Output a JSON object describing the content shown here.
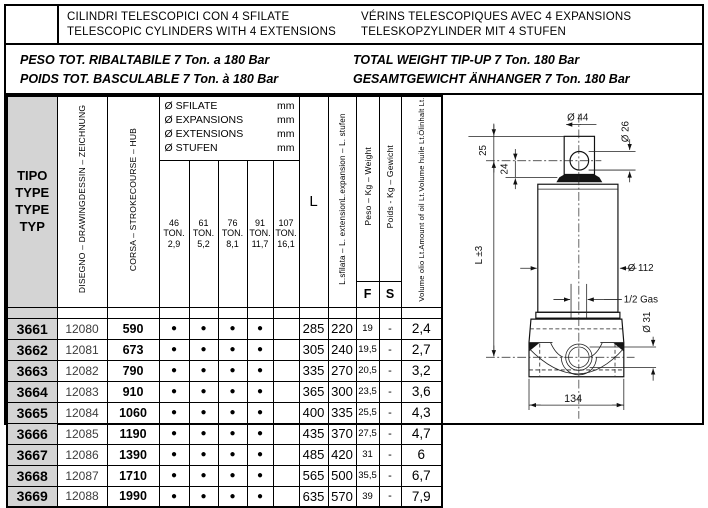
{
  "page": {
    "title_block": {
      "line_it": "CILINDRI TELESCOPICI CON 4 SFILATE",
      "line_en": "TELESCOPIC CYLINDERS WITH 4 EXTENSIONS",
      "line_fr": "VÉRINS TELESCOPIQUES AVEC 4 EXPANSIONS",
      "line_de": "TELESKOPZYLINDER MIT 4 STUFEN"
    },
    "weight_block": {
      "line_it": "PESO TOT. RIBALTABILE 7 Ton. a 180 Bar",
      "line_fr": "POIDS TOT. BASCULABLE 7 Ton. à 180 Bar",
      "line_en": "TOTAL WEIGHT TIP-UP  7 Ton. 180 Bar",
      "line_de": "GESAMTGEWICHT ÄNHANGER 7 Ton. 180 Bar"
    }
  },
  "table": {
    "bullet": "●",
    "headers": {
      "tipo_lines": [
        "TIPO",
        "TYPE",
        "TYPE",
        "TYP"
      ],
      "disegno_lines": [
        "DISEGNO – DRAWING",
        "DESSIN – ZEICHNUNG"
      ],
      "corsa_lines": [
        "CORSA  – STROKE",
        "COURSE – HUB"
      ],
      "diam_lines": [
        [
          "Ø SFILATE",
          "mm"
        ],
        [
          "Ø EXPANSIONS",
          "mm"
        ],
        [
          "Ø EXTENSIONS",
          "mm"
        ],
        [
          "Ø STUFEN",
          "mm"
        ]
      ],
      "ton_cols": [
        {
          "size": "46",
          "unit": "TON.",
          "cap": "2,9"
        },
        {
          "size": "61",
          "unit": "TON.",
          "cap": "5,2"
        },
        {
          "size": "76",
          "unit": "TON.",
          "cap": "8,1"
        },
        {
          "size": "91",
          "unit": "TON.",
          "cap": "11,7"
        },
        {
          "size": "107",
          "unit": "TON.",
          "cap": "16,1"
        }
      ],
      "length": "L",
      "lsf_lines": [
        "L.sfilata – L. extension",
        "L.expansion – L. stufen"
      ],
      "peso": "Peso – Kg – Weight",
      "poids": "Poids - Kg – Gewicht",
      "f": "F",
      "s": "S",
      "volume_lines": [
        "Volume olio Lt.",
        "Amount of oil Lt.",
        "Volume huile Lt.",
        "Ölinhalt Lt."
      ]
    },
    "rows": [
      {
        "tipo": "3661",
        "disegno": "12080",
        "corsa": "590",
        "ext": [
          1,
          1,
          1,
          1,
          0
        ],
        "L": "285",
        "lsf": "220",
        "F": "19",
        "S": "-",
        "vol": "2,4"
      },
      {
        "tipo": "3662",
        "disegno": "12081",
        "corsa": "673",
        "ext": [
          1,
          1,
          1,
          1,
          0
        ],
        "L": "305",
        "lsf": "240",
        "F": "19,5",
        "S": "-",
        "vol": "2,7"
      },
      {
        "tipo": "3663",
        "disegno": "12082",
        "corsa": "790",
        "ext": [
          1,
          1,
          1,
          1,
          0
        ],
        "L": "335",
        "lsf": "270",
        "F": "20,5",
        "S": "-",
        "vol": "3,2"
      },
      {
        "tipo": "3664",
        "disegno": "12083",
        "corsa": "910",
        "ext": [
          1,
          1,
          1,
          1,
          0
        ],
        "L": "365",
        "lsf": "300",
        "F": "23,5",
        "S": "-",
        "vol": "3,6"
      },
      {
        "tipo": "3665",
        "disegno": "12084",
        "corsa": "1060",
        "ext": [
          1,
          1,
          1,
          1,
          0
        ],
        "L": "400",
        "lsf": "335",
        "F": "25,5",
        "S": "-",
        "vol": "4,3"
      },
      {
        "tipo": "3666",
        "disegno": "12085",
        "corsa": "1190",
        "ext": [
          1,
          1,
          1,
          1,
          0
        ],
        "L": "435",
        "lsf": "370",
        "F": "27,5",
        "S": "-",
        "vol": "4,7"
      },
      {
        "tipo": "3667",
        "disegno": "12086",
        "corsa": "1390",
        "ext": [
          1,
          1,
          1,
          1,
          0
        ],
        "L": "485",
        "lsf": "420",
        "F": "31",
        "S": "-",
        "vol": "6"
      },
      {
        "tipo": "3668",
        "disegno": "12087",
        "corsa": "1710",
        "ext": [
          1,
          1,
          1,
          1,
          0
        ],
        "L": "565",
        "lsf": "500",
        "F": "35,5",
        "S": "-",
        "vol": "6,7"
      },
      {
        "tipo": "3669",
        "disegno": "12088",
        "corsa": "1990",
        "ext": [
          1,
          1,
          1,
          1,
          0
        ],
        "L": "635",
        "lsf": "570",
        "F": "39",
        "S": "-",
        "vol": "7,9"
      }
    ]
  },
  "drawing": {
    "dims": {
      "eye_width": "Ø 44",
      "eye_hole": "Ø 26",
      "eye_top_to_axis": "25",
      "axis_to_shoulder": "24",
      "closed_length": "L ±3",
      "body_diameter": "Ø 112",
      "oil_port": "1/2 Gas",
      "base_hole": "Ø 31",
      "base_width": "134"
    }
  },
  "colors": {
    "header_gray": "#d4d4d4",
    "line_black": "#000000"
  }
}
